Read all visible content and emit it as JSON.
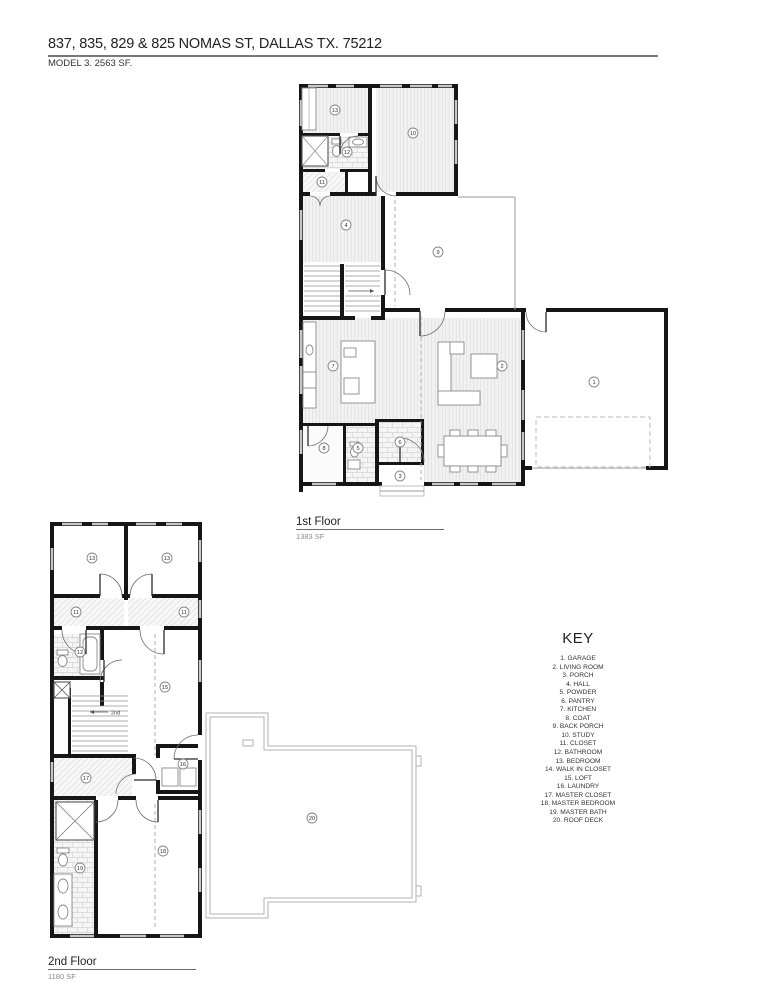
{
  "page": {
    "title": "837, 835, 829 & 825 NOMAS ST, DALLAS TX. 75212",
    "subtitle": "MODEL 3. 2563 SF."
  },
  "floors": {
    "first": {
      "label": "1st Floor",
      "area": "1383 SF"
    },
    "second": {
      "label": "2nd Floor",
      "area": "1180 SF",
      "stair_note": "2nd"
    }
  },
  "key": {
    "heading": "KEY",
    "items": [
      "1. GARAGE",
      "2. LIVING ROOM",
      "3. PORCH",
      "4. HALL",
      "5. POWDER",
      "6. PANTRY",
      "7. KITCHEN",
      "8. COAT",
      "9. BACK PORCH",
      "10. STUDY",
      "11. CLOSET",
      "12. BATHROOM",
      "13. BEDROOM",
      "14. WALK IN CLOSET",
      "15. LOFT",
      "16. LAUNDRY",
      "17. MASTER CLOSET",
      "18. MASTER BEDROOM",
      "19. MASTER BATH",
      "20. ROOF DECK"
    ]
  },
  "plan_markers": {
    "first": [
      {
        "n": "13",
        "x": 335,
        "y": 110
      },
      {
        "n": "12",
        "x": 347,
        "y": 152
      },
      {
        "n": "11",
        "x": 322,
        "y": 182
      },
      {
        "n": "10",
        "x": 413,
        "y": 133
      },
      {
        "n": "4",
        "x": 346,
        "y": 225
      },
      {
        "n": "9",
        "x": 438,
        "y": 252
      },
      {
        "n": "7",
        "x": 333,
        "y": 366
      },
      {
        "n": "2",
        "x": 502,
        "y": 366
      },
      {
        "n": "1",
        "x": 594,
        "y": 382
      },
      {
        "n": "8",
        "x": 324,
        "y": 448
      },
      {
        "n": "5",
        "x": 358,
        "y": 448
      },
      {
        "n": "6",
        "x": 400,
        "y": 442
      },
      {
        "n": "3",
        "x": 400,
        "y": 476
      }
    ],
    "second": [
      {
        "n": "13",
        "x": 92,
        "y": 558
      },
      {
        "n": "13",
        "x": 167,
        "y": 558
      },
      {
        "n": "11",
        "x": 76,
        "y": 612
      },
      {
        "n": "11",
        "x": 184,
        "y": 612
      },
      {
        "n": "12",
        "x": 80,
        "y": 652
      },
      {
        "n": "15",
        "x": 165,
        "y": 687
      },
      {
        "n": "16",
        "x": 183,
        "y": 764
      },
      {
        "n": "17",
        "x": 86,
        "y": 778
      },
      {
        "n": "19",
        "x": 80,
        "y": 868
      },
      {
        "n": "18",
        "x": 163,
        "y": 851
      },
      {
        "n": "20",
        "x": 312,
        "y": 818
      }
    ]
  },
  "colors": {
    "ink": "#161616",
    "window": "#c6c6c6",
    "hatch": "#e0e0e0",
    "deck_outline": "#b2b2b2",
    "text": "#222222"
  }
}
